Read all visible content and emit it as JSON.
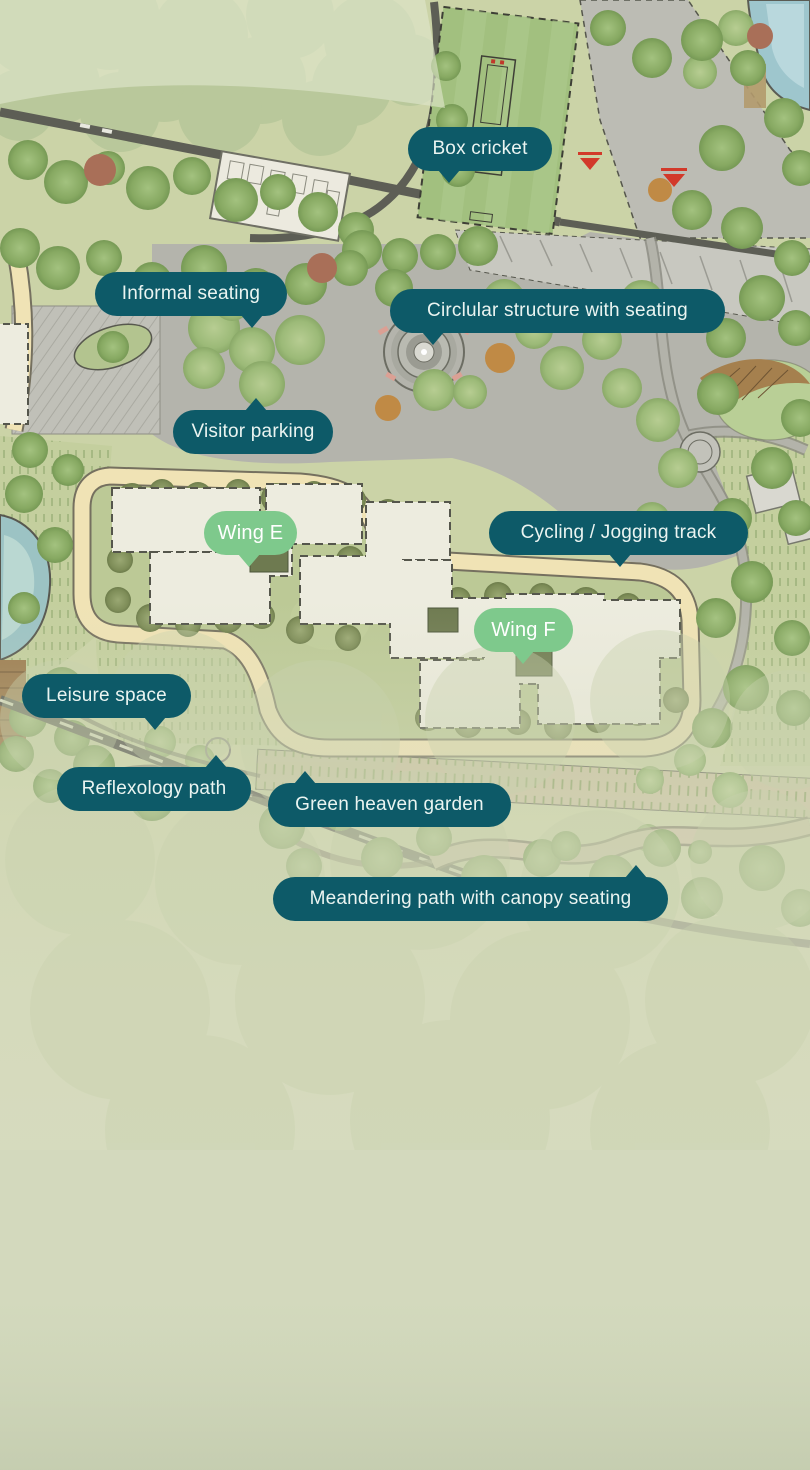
{
  "map": {
    "labels": [
      {
        "id": "box-cricket",
        "text": "Box cricket",
        "style": "teal",
        "x": 408,
        "y": 127,
        "w": 144,
        "tail": "bottom",
        "tail_x": 30
      },
      {
        "id": "informal-seating",
        "text": "Informal seating",
        "style": "teal",
        "x": 95,
        "y": 272,
        "w": 192,
        "tail": "bottom",
        "tail_x": 146
      },
      {
        "id": "circular-structure-with-seating",
        "text": "Circlular structure with seating",
        "style": "teal",
        "x": 390,
        "y": 289,
        "w": 335,
        "tail": "bottom",
        "tail_x": 32
      },
      {
        "id": "visitor-parking",
        "text": "Visitor parking",
        "style": "teal",
        "x": 173,
        "y": 410,
        "w": 160,
        "tail": "top",
        "tail_x": 72
      },
      {
        "id": "wing-e",
        "text": "Wing E",
        "style": "green",
        "x": 204,
        "y": 511,
        "w": 93,
        "tail": "bottom",
        "tail_x": 34
      },
      {
        "id": "cycling-jogging-track",
        "text": "Cycling / Jogging track",
        "style": "teal",
        "x": 489,
        "y": 511,
        "w": 259,
        "tail": "bottom",
        "tail_x": 120
      },
      {
        "id": "wing-f",
        "text": "Wing F",
        "style": "green",
        "x": 474,
        "y": 608,
        "w": 99,
        "tail": "bottom",
        "tail_x": 38
      },
      {
        "id": "leisure-space",
        "text": "Leisure space",
        "style": "teal",
        "x": 22,
        "y": 674,
        "w": 169,
        "tail": "bottom",
        "tail_x": 122
      },
      {
        "id": "reflexology-path",
        "text": "Reflexology path",
        "style": "teal",
        "x": 57,
        "y": 767,
        "w": 194,
        "tail": "top",
        "tail_x": 148
      },
      {
        "id": "green-heaven-garden",
        "text": "Green heaven garden",
        "style": "teal",
        "x": 268,
        "y": 783,
        "w": 243,
        "tail": "top",
        "tail_x": 26
      },
      {
        "id": "meandering-path-with-canopy-seating",
        "text": "Meandering path with canopy seating",
        "style": "teal",
        "x": 273,
        "y": 877,
        "w": 395,
        "tail": "top",
        "tail_x": 352
      }
    ],
    "colors": {
      "label_teal": "#0d5a68",
      "label_green": "#7ec98c",
      "label_text": "#eaf4f1",
      "wing_label_text": "#ffffff"
    }
  }
}
